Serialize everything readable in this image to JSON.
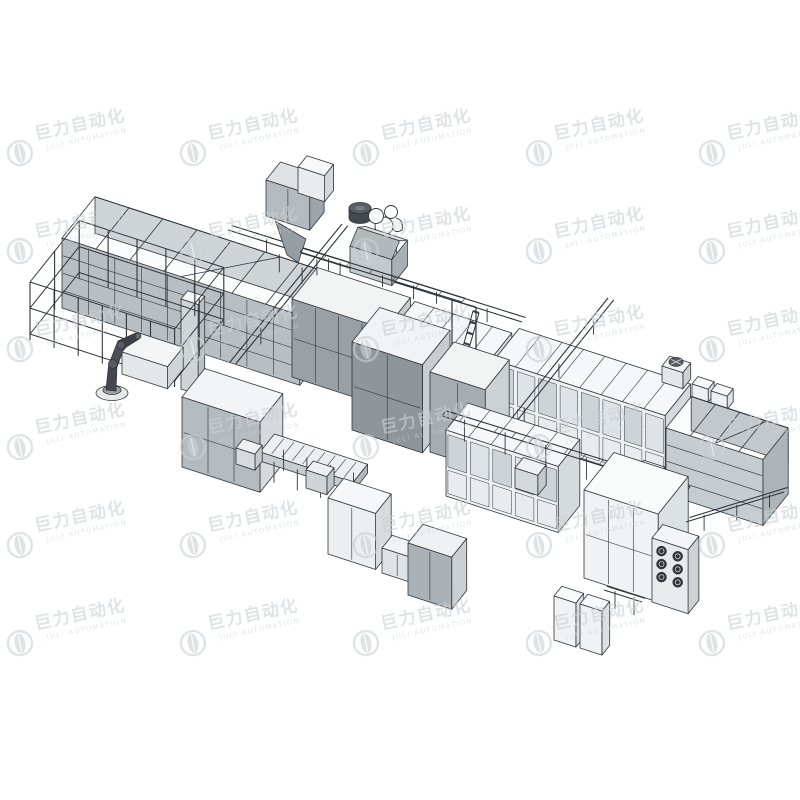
{
  "watermark": {
    "brand_cn": "巨力自动化",
    "brand_en": "JULI AUTOMATION",
    "color": "#ccd1d5",
    "opacity": 0.6,
    "grid": {
      "columns": 5,
      "rows": 6
    }
  },
  "illustration": {
    "alt": "Grayscale isometric 3D CAD rendering of an automated assembly production line with fenced robot cell, machine cabinets, glass enclosure lines, hopper tower, overhead rails, conveyors and open-top material bins",
    "palette": {
      "background": "#ffffff",
      "outline": "#2f353a",
      "fill_light": "#eef0f1",
      "fill_mid": "#c3cacd",
      "fill_dark": "#8f979c"
    }
  }
}
